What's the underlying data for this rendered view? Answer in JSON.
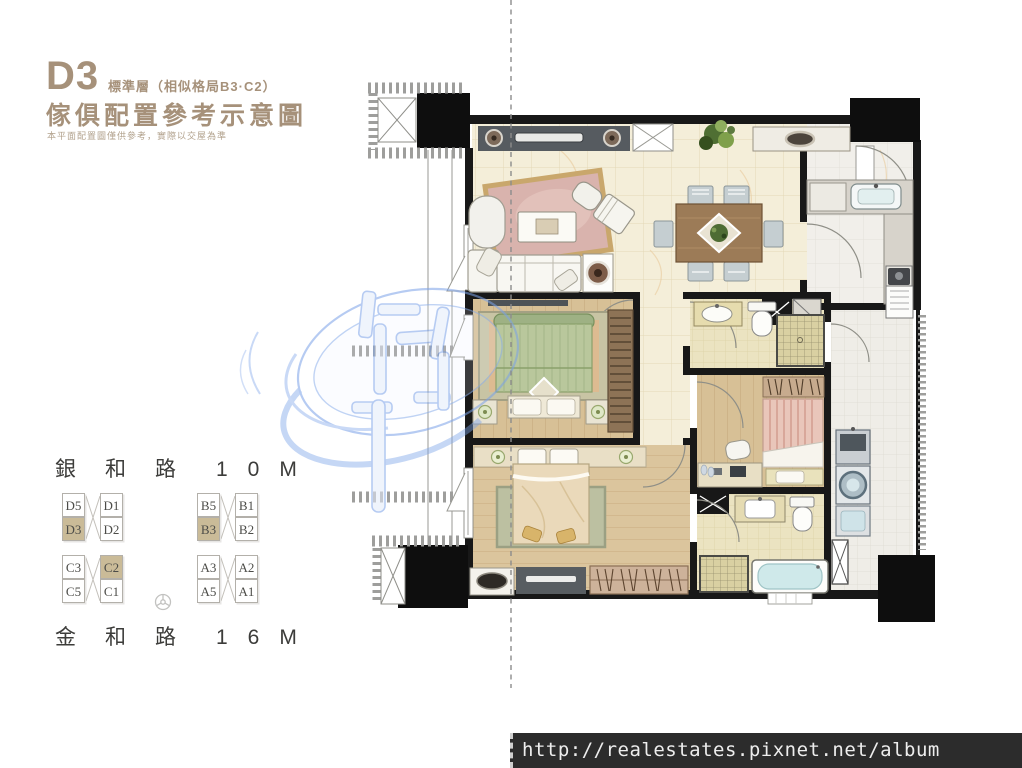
{
  "header": {
    "unit_code": "D3",
    "floor_note": "標準層（相似格局B3·C2）",
    "title": "傢俱配置參考示意圖",
    "disclaimer": "本平面配置圖僅供參考，實際以交屋為準"
  },
  "roads": {
    "top": {
      "name": "銀和路",
      "width": "10M"
    },
    "bottom": {
      "name": "金和路",
      "width": "16M"
    }
  },
  "unit_grid": {
    "blocks": [
      {
        "id": "D",
        "rows": [
          [
            {
              "label": "D5",
              "highlighted": false
            },
            {
              "label": "D1",
              "highlighted": false
            }
          ],
          [
            {
              "label": "D3",
              "highlighted": true
            },
            {
              "label": "D2",
              "highlighted": false
            }
          ]
        ]
      },
      {
        "id": "C",
        "rows": [
          [
            {
              "label": "C3",
              "highlighted": false
            },
            {
              "label": "C2",
              "highlighted": true
            }
          ],
          [
            {
              "label": "C5",
              "highlighted": false
            },
            {
              "label": "C1",
              "highlighted": false
            }
          ]
        ]
      },
      {
        "id": "B",
        "rows": [
          [
            {
              "label": "B5",
              "highlighted": false
            },
            {
              "label": "B1",
              "highlighted": false
            }
          ],
          [
            {
              "label": "B3",
              "highlighted": true
            },
            {
              "label": "B2",
              "highlighted": false
            }
          ]
        ]
      },
      {
        "id": "A",
        "rows": [
          [
            {
              "label": "A3",
              "highlighted": false
            },
            {
              "label": "A2",
              "highlighted": false
            }
          ],
          [
            {
              "label": "A5",
              "highlighted": false
            },
            {
              "label": "A1",
              "highlighted": false
            }
          ]
        ]
      }
    ]
  },
  "watermark": {
    "url": "http://realestates.pixnet.net/album"
  },
  "colors": {
    "accent_tan": "#a6917a",
    "unit_highlight": "#cabb98",
    "watermark_blue": "#7aa2e8",
    "url_bar_bg": "#2c2c2c"
  }
}
